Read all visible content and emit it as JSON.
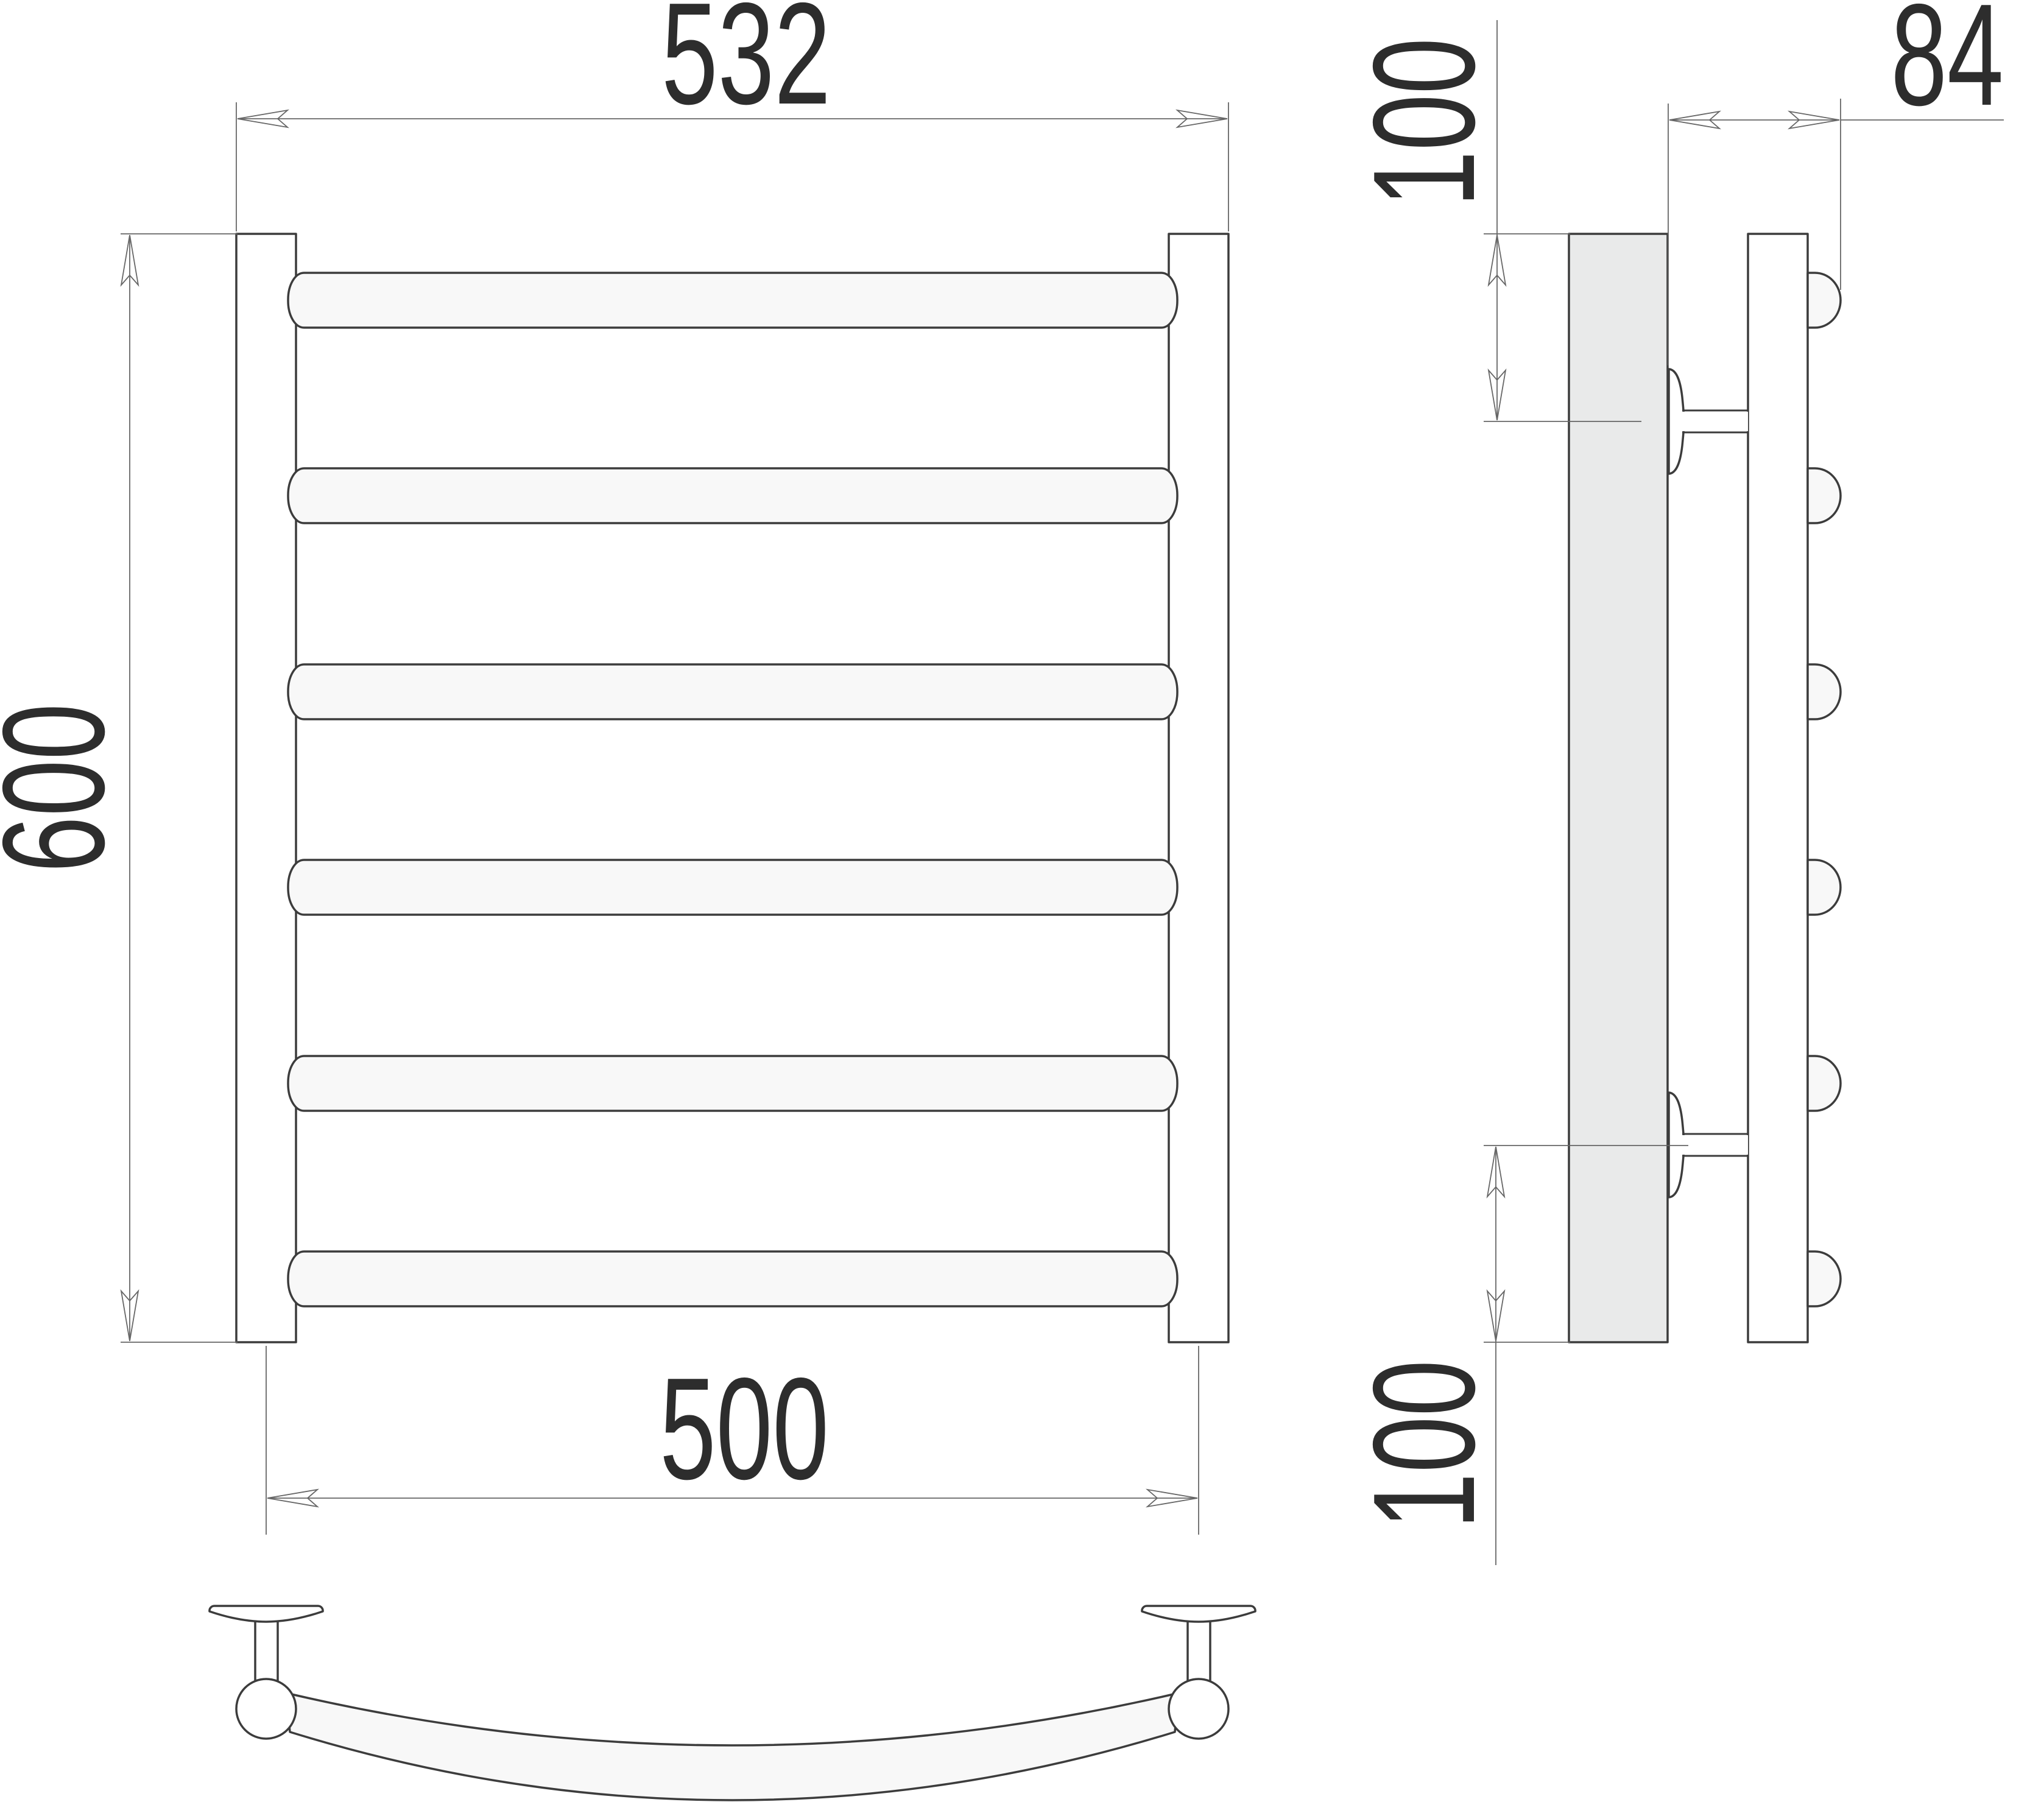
{
  "drawing": {
    "type": "technical-drawing",
    "subject": "ladder-towel-rail",
    "bar_count": 6,
    "front_view": {
      "width_label": "532",
      "height_label": "600",
      "spacing_label": "500"
    },
    "side_view": {
      "depth_label": "84",
      "top_offset_label": "100",
      "bottom_offset_label": "100"
    },
    "colors": {
      "line": "#3c3c3c",
      "dim_line": "#666666",
      "text": "#2d2d2d",
      "wall_fill": "#e9eaea",
      "bar_fill": "#f8f8f8",
      "background": "#ffffff"
    }
  }
}
